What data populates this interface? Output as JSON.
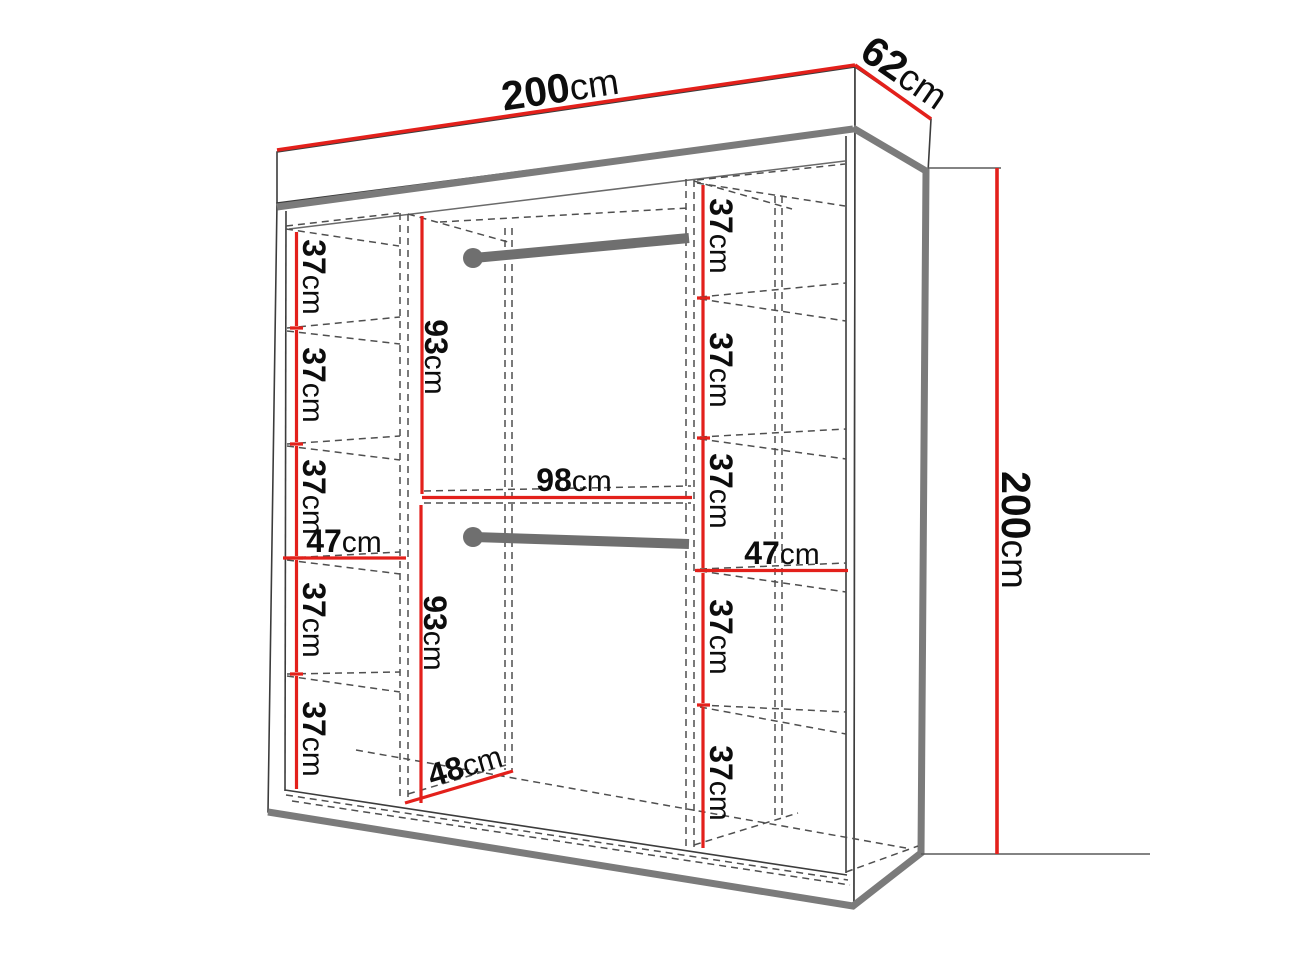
{
  "diagram": {
    "title": "wardrobe-dimension-diagram",
    "unit": "cm",
    "colors": {
      "dimension_line": "#e3201b",
      "structure_thick": "#7b7b7b",
      "structure_thin": "#3c3c3c",
      "dashed_line": "#4f4f4f",
      "text": "#0d0d0d",
      "background": "#ffffff"
    },
    "dimensions": {
      "top_width": {
        "value": "200",
        "unit": "cm"
      },
      "top_depth": {
        "value": "62",
        "unit": "cm"
      },
      "side_height": {
        "value": "200",
        "unit": "cm"
      },
      "left_column": {
        "sections": [
          {
            "value": "37",
            "unit": "cm"
          },
          {
            "value": "37",
            "unit": "cm"
          },
          {
            "value": "37",
            "unit": "cm"
          },
          {
            "value": "37",
            "unit": "cm"
          },
          {
            "value": "37",
            "unit": "cm"
          }
        ],
        "width": {
          "value": "47",
          "unit": "cm"
        }
      },
      "middle_column": {
        "upper_height": {
          "value": "93",
          "unit": "cm"
        },
        "width": {
          "value": "98",
          "unit": "cm"
        },
        "lower_height": {
          "value": "93",
          "unit": "cm"
        },
        "depth": {
          "value": "48",
          "unit": "cm"
        }
      },
      "right_column": {
        "sections": [
          {
            "value": "37",
            "unit": "cm"
          },
          {
            "value": "37",
            "unit": "cm"
          },
          {
            "value": "37",
            "unit": "cm"
          },
          {
            "value": "37",
            "unit": "cm"
          },
          {
            "value": "37",
            "unit": "cm"
          }
        ],
        "width": {
          "value": "47",
          "unit": "cm"
        }
      }
    }
  }
}
